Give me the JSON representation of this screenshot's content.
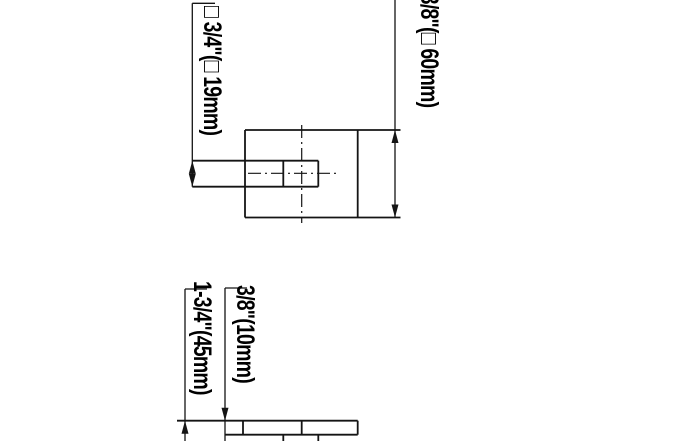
{
  "drawing": {
    "background_color": "#ffffff",
    "line_color": "#141414",
    "label_color": "#000000",
    "dimensions": {
      "spindle_square": {
        "label": "□ 3/4\"(□ 19mm)",
        "inches": "3/4",
        "mm": 19
      },
      "rosette_square": {
        "label": "2-3/8\"(□ 60mm)",
        "inches": "2-3/8",
        "mm": 60
      },
      "projection": {
        "label": "1-3/4\"(45mm)",
        "inches": "1-3/4",
        "mm": 45
      },
      "base_thickness": {
        "label": "3/8\"(10mm)",
        "inches": "3/8",
        "mm": 10
      }
    }
  }
}
